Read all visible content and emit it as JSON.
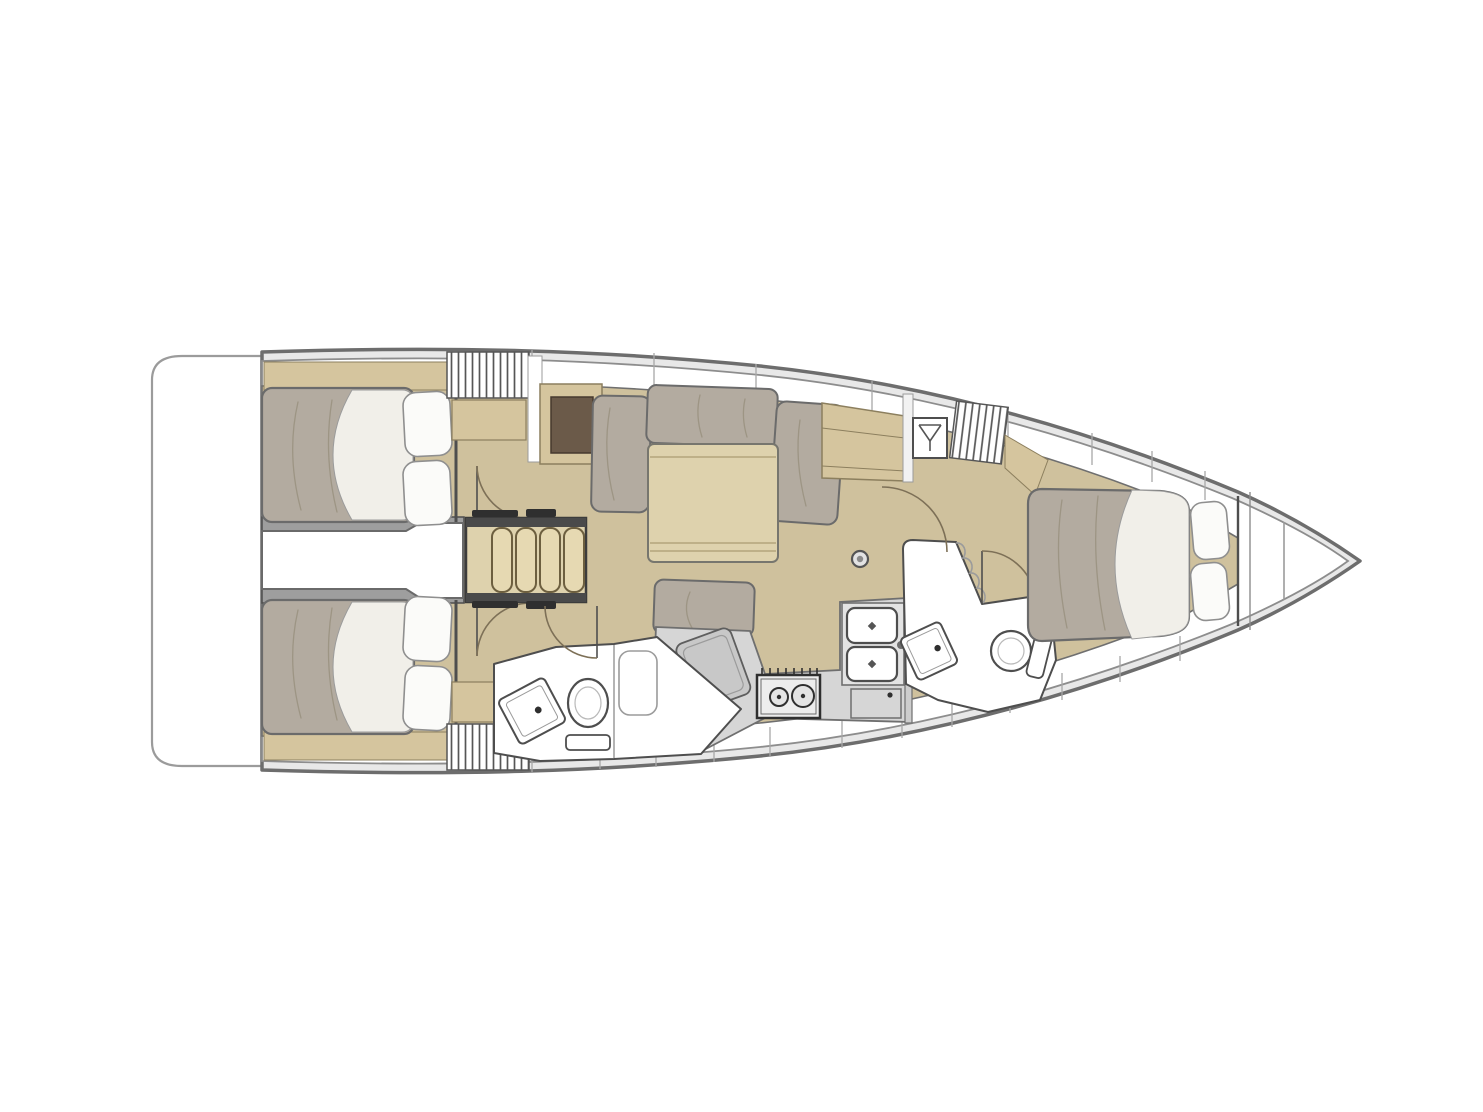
{
  "page": {
    "background": "#ffffff",
    "description": "Sailing yacht interior floor plan, top view, bow pointing right",
    "canvas": {
      "width": 1483,
      "height": 1112
    }
  },
  "colors": {
    "pageBg": "#ffffff",
    "hullStroke": "#6d6d6d",
    "hullRing": "#e8e8e8",
    "innerStroke": "#8d8d8d",
    "deck": "#ffffff",
    "wall": "#4e4e4e",
    "soft": "#9b9b9b",
    "floor": "#cfc19d",
    "wood": "#ded2ad",
    "woodMid": "#d5c59e",
    "woodEdge": "#8c7f5e",
    "darkWood": "#6b5a49",
    "cushion": "#b3aba0",
    "cushionStroke": "#6b6b6b",
    "pillow": "#fbfbf9",
    "pillowStroke": "#8f8f8f",
    "sheet": "#f1efe9",
    "whiteRoom": "#ffffff",
    "counter": "#d6d6d6",
    "counterDark": "#c8c8c8",
    "appliance": "#ededed",
    "hardware": "#2f2f2f",
    "railDark": "#4a4a4a",
    "corridorWall": "#9e9e9e",
    "arc": "#7d7057",
    "wrinkle": "#99917f",
    "divider": "#a8a8a8",
    "slatStroke": "#565656"
  },
  "legend": {
    "rooms": [
      "swim-platform",
      "aft-cabin-port",
      "aft-cabin-starboard",
      "engine-compartment",
      "companionway-steps",
      "salon",
      "galley",
      "aft-head",
      "forward-head",
      "forward-cabin",
      "bow-locker"
    ],
    "icons": [
      "hanger-icon",
      "toilet-icon",
      "washbasin-icon",
      "double-sink-icon",
      "stove-icon",
      "fridge-icon",
      "mast-step-icon",
      "door-arc-icon",
      "locker-slats-icon",
      "berth-icon",
      "settee-icon",
      "table-icon",
      "shower-icon"
    ]
  }
}
